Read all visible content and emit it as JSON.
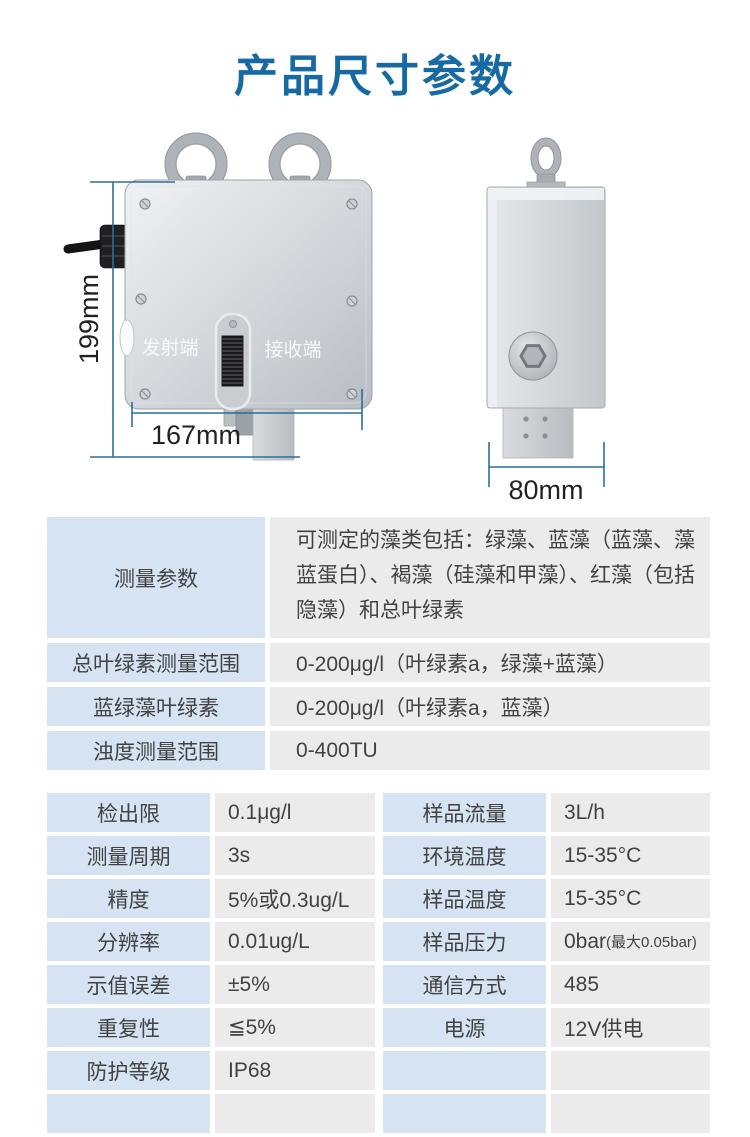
{
  "page": {
    "title": "产品尺寸参数"
  },
  "colors": {
    "title_blue": "#1769a4",
    "dim_blue": "#2a6f9f",
    "cell_label_bg": "#d5e3f3",
    "cell_value_bg": "#ebebeb",
    "cell_text": "#424242",
    "dim_text": "#222222"
  },
  "figure": {
    "front_view": {
      "transmitter_label": "发射端",
      "receiver_label": "接收端",
      "height_dim": "199mm",
      "width_dim": "167mm"
    },
    "side_view": {
      "width_dim": "80mm"
    }
  },
  "range_table": {
    "rows": [
      {
        "label": "测量参数",
        "value": "可测定的藻类包括：绿藻、蓝藻（蓝藻、藻蓝蛋白）、褐藻（硅藻和甲藻）、红藻（包括隐藻）和总叶绿素"
      },
      {
        "label": "总叶绿素测量范围",
        "value": "0-200μg/l（叶绿素a，绿藻+蓝藻）"
      },
      {
        "label": "蓝绿藻叶绿素",
        "value": "0-200μg/l（叶绿素a，蓝藻）"
      },
      {
        "label": "浊度测量范围",
        "value": "0-400TU"
      }
    ]
  },
  "spec_table": {
    "left": [
      {
        "label": "检出限",
        "value": "0.1μg/l"
      },
      {
        "label": "测量周期",
        "value": "3s"
      },
      {
        "label": "精度",
        "value": "5%或0.3ug/L"
      },
      {
        "label": "分辨率",
        "value": "0.01ug/L"
      },
      {
        "label": "示值误差",
        "value": "±5%"
      },
      {
        "label": "重复性",
        "value": "≦5%"
      },
      {
        "label": "防护等级",
        "value": "IP68"
      },
      {
        "label": "",
        "value": ""
      }
    ],
    "right": [
      {
        "label": "样品流量",
        "value": "3L/h"
      },
      {
        "label": "环境温度",
        "value": "15-35°C"
      },
      {
        "label": "样品温度",
        "value": "15-35°C"
      },
      {
        "label": "样品压力",
        "value": "0bar",
        "value_small": "(最大0.05bar)"
      },
      {
        "label": "通信方式",
        "value": "485"
      },
      {
        "label": "电源",
        "value": "12V供电"
      },
      {
        "label": "",
        "value": ""
      },
      {
        "label": "",
        "value": ""
      }
    ]
  }
}
